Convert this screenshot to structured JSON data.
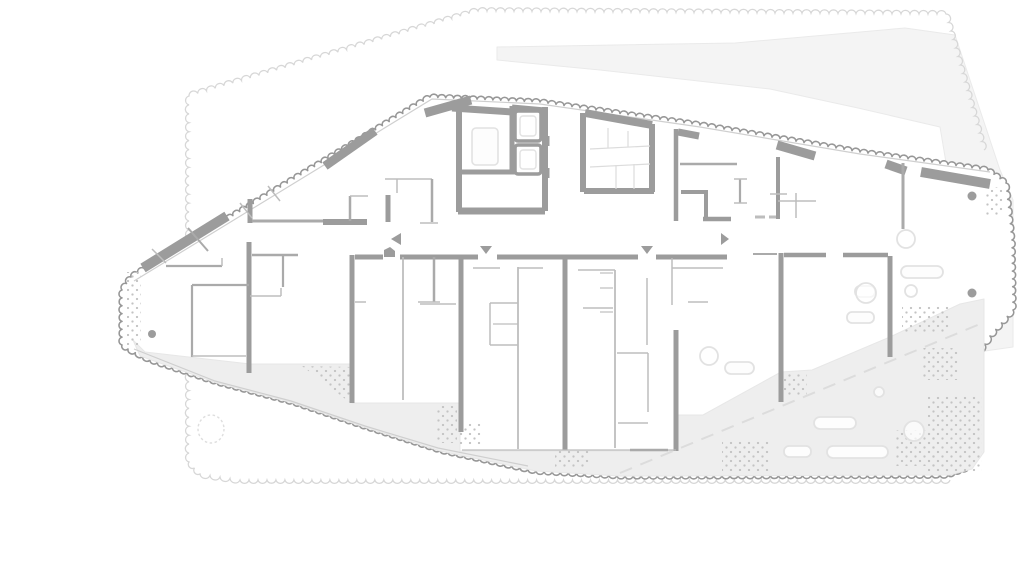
{
  "meta": {
    "label": "architectural floor plan",
    "width": 1024,
    "height": 573
  },
  "colors": {
    "wall": "#9c9c9c",
    "med": "#a6a6a6",
    "part": "#aaaaaa",
    "thin": "#bdbdbd",
    "glaze": "#cfcfcf",
    "boundary": "#979797",
    "ctxLine": "#d7d7d7",
    "ctxFill": "#f4f4f4",
    "ctxStroke": "#eaeaea",
    "terrace": "#eeeeee",
    "terraceStroke": "#e7e7e7",
    "stipple": "#c3c3c3",
    "furn": "#e2e2e2",
    "furnFill": "#fdfdfd",
    "tread": "#dcdcdc",
    "dash": "#dcdcdc",
    "cloud": "#dedede",
    "white": "#ffffff"
  },
  "boundary": {
    "wavelength": 8,
    "strokeWidth": 1.6,
    "pts": [
      [
        122,
        345
      ],
      [
        122,
        290
      ],
      [
        131,
        277
      ],
      [
        430,
        97
      ],
      [
        540,
        102
      ],
      [
        700,
        125
      ],
      [
        860,
        152
      ],
      [
        988,
        170
      ],
      [
        1006,
        183
      ],
      [
        1012,
        240
      ],
      [
        1013,
        310
      ],
      [
        990,
        336
      ],
      [
        979,
        352
      ],
      [
        979,
        450
      ],
      [
        968,
        468
      ],
      [
        948,
        475
      ],
      [
        625,
        476
      ],
      [
        536,
        471
      ],
      [
        440,
        450
      ],
      [
        367,
        427
      ],
      [
        293,
        402
      ],
      [
        217,
        382
      ],
      [
        150,
        360
      ],
      [
        128,
        349
      ]
    ]
  },
  "contextOutline": {
    "wavelength": 9,
    "strokeWidth": 1.3,
    "pts": [
      [
        950,
        480
      ],
      [
        240,
        480
      ],
      [
        200,
        474
      ],
      [
        189,
        462
      ],
      [
        189,
        96
      ],
      [
        478,
        11
      ],
      [
        946,
        14
      ],
      [
        984,
        150
      ]
    ]
  },
  "contextShape": {
    "pts": [
      [
        497,
        47
      ],
      [
        735,
        43
      ],
      [
        905,
        28
      ],
      [
        955,
        35
      ],
      [
        1000,
        170
      ],
      [
        1013,
        200
      ],
      [
        1013,
        347
      ],
      [
        978,
        352
      ],
      [
        940,
        127
      ],
      [
        858,
        108
      ],
      [
        770,
        89
      ],
      [
        600,
        70
      ],
      [
        497,
        60
      ]
    ]
  },
  "terrace": {
    "pts": [
      [
        133,
        340
      ],
      [
        145,
        352
      ],
      [
        250,
        364
      ],
      [
        352,
        364
      ],
      [
        352,
        403
      ],
      [
        460,
        403
      ],
      [
        460,
        451
      ],
      [
        674,
        451
      ],
      [
        674,
        415
      ],
      [
        703,
        415
      ],
      [
        781,
        372
      ],
      [
        812,
        370
      ],
      [
        890,
        337
      ],
      [
        960,
        304
      ],
      [
        984,
        299
      ],
      [
        984,
        452
      ],
      [
        972,
        469
      ],
      [
        950,
        475
      ],
      [
        620,
        476
      ],
      [
        536,
        471
      ],
      [
        440,
        451
      ],
      [
        367,
        428
      ],
      [
        293,
        403
      ],
      [
        217,
        383
      ],
      [
        140,
        356
      ]
    ]
  },
  "glazing": [
    [
      [
        134,
        281
      ],
      [
        432,
        99
      ],
      [
        540,
        104
      ],
      [
        700,
        127
      ],
      [
        860,
        154
      ],
      [
        990,
        172
      ]
    ],
    [
      [
        134,
        349
      ],
      [
        215,
        381
      ],
      [
        291,
        401
      ],
      [
        365,
        426
      ],
      [
        438,
        448
      ],
      [
        528,
        466
      ]
    ]
  ],
  "lines": [
    [
      143,
      268,
      227,
      216,
      10
    ],
    [
      325,
      166,
      375,
      131,
      9
    ],
    [
      425,
      113,
      471,
      100,
      9
    ],
    [
      777,
      145,
      815,
      156,
      9
    ],
    [
      886,
      164,
      906,
      171,
      9
    ],
    [
      921,
      172,
      990,
      184,
      10
    ],
    [
      459,
      106,
      459,
      212,
      6
    ],
    [
      452,
      108,
      512,
      112,
      7
    ],
    [
      512,
      106,
      512,
      172,
      5
    ],
    [
      512,
      108,
      545,
      111,
      7
    ],
    [
      545,
      107,
      545,
      211,
      6
    ],
    [
      461,
      172,
      517,
      172,
      5
    ],
    [
      458,
      211,
      545,
      211,
      7
    ],
    [
      546,
      136,
      546,
      146,
      7
    ],
    [
      546,
      168,
      546,
      178,
      7
    ],
    [
      583,
      113,
      583,
      192,
      6
    ],
    [
      585,
      113,
      652,
      125,
      8
    ],
    [
      652,
      124,
      652,
      192,
      6
    ],
    [
      584,
      191,
      654,
      191,
      6
    ],
    [
      676,
      129,
      676,
      221,
      4.5
    ],
    [
      678,
      132,
      699,
      136,
      7
    ],
    [
      681,
      192,
      707,
      192,
      4
    ],
    [
      706,
      190,
      706,
      219,
      4
    ],
    [
      703,
      219,
      731,
      219,
      4.5
    ],
    [
      680,
      164,
      737,
      164,
      2.5
    ],
    [
      740,
      179,
      740,
      203,
      2.2
    ],
    [
      734,
      179,
      747,
      179,
      1.5
    ],
    [
      734,
      203,
      747,
      203,
      1.5
    ],
    [
      755,
      217,
      765,
      217,
      3,
      "thin"
    ],
    [
      769,
      217,
      779,
      217,
      3,
      "thin"
    ],
    [
      778,
      157,
      778,
      219,
      4
    ],
    [
      778,
      201,
      816,
      201,
      1.5
    ],
    [
      796,
      193,
      796,
      218,
      1.5
    ],
    [
      770,
      194,
      787,
      194,
      1.5
    ],
    [
      903,
      163,
      903,
      229,
      3
    ],
    [
      250,
      199,
      250,
      223,
      5
    ],
    [
      252,
      221,
      324,
      221,
      3
    ],
    [
      323,
      222,
      367,
      222,
      6
    ],
    [
      388,
      195,
      388,
      222,
      5
    ],
    [
      350,
      196,
      350,
      221,
      2.5
    ],
    [
      350,
      196,
      368,
      196,
      1.5
    ],
    [
      385,
      179,
      432,
      179,
      1.5
    ],
    [
      397,
      179,
      397,
      193,
      1.5
    ],
    [
      432,
      179,
      432,
      222,
      2.5
    ],
    [
      420,
      223,
      438,
      223,
      1.5
    ],
    [
      252,
      255,
      298,
      255,
      2.5
    ],
    [
      355,
      257,
      383,
      257,
      5
    ],
    [
      400,
      257,
      478,
      257,
      5
    ],
    [
      497,
      257,
      638,
      257,
      5
    ],
    [
      656,
      257,
      727,
      257,
      5
    ],
    [
      753,
      254,
      777,
      254,
      2
    ],
    [
      784,
      255,
      826,
      255,
      4.5
    ],
    [
      843,
      255,
      888,
      255,
      4.5
    ],
    [
      249,
      242,
      249,
      373,
      5
    ],
    [
      352,
      255,
      352,
      403,
      5
    ],
    [
      461,
      257,
      461,
      432,
      5
    ],
    [
      565,
      257,
      565,
      450,
      5
    ],
    [
      676,
      330,
      676,
      451,
      5
    ],
    [
      781,
      253,
      781,
      402,
      5
    ],
    [
      890,
      256,
      890,
      357,
      5
    ],
    [
      403,
      257,
      403,
      400,
      1.8
    ],
    [
      434,
      257,
      434,
      302,
      2.5
    ],
    [
      518,
      267,
      518,
      449,
      1.8
    ],
    [
      615,
      270,
      615,
      448,
      1.8
    ],
    [
      283,
      254,
      283,
      287,
      2.2
    ],
    [
      250,
      296,
      281,
      296,
      1.5
    ],
    [
      281,
      288,
      281,
      296,
      1.5
    ],
    [
      192,
      285,
      192,
      357,
      2.2
    ],
    [
      192,
      285,
      249,
      285,
      2.2
    ],
    [
      192,
      356,
      246,
      356,
      1.5
    ],
    [
      166,
      266,
      222,
      266,
      2.2
    ],
    [
      222,
      258,
      222,
      266,
      1.5
    ],
    [
      188,
      228,
      208,
      251,
      2
    ],
    [
      152,
      249,
      166,
      263,
      1.5
    ],
    [
      240,
      203,
      252,
      218,
      1.5
    ],
    [
      268,
      186,
      280,
      201,
      1.5
    ],
    [
      418,
      302,
      440,
      302,
      1.5
    ],
    [
      355,
      302,
      366,
      302,
      1.5
    ],
    [
      473,
      268,
      500,
      268,
      1.5
    ],
    [
      518,
      268,
      543,
      268,
      1.5
    ],
    [
      578,
      270,
      615,
      270,
      1.5
    ],
    [
      583,
      308,
      613,
      308,
      1.5
    ],
    [
      420,
      304,
      456,
      304,
      1.5
    ],
    [
      490,
      303,
      490,
      345,
      1.5
    ],
    [
      490,
      303,
      518,
      303,
      1.5
    ],
    [
      490,
      345,
      518,
      345,
      1.5
    ],
    [
      493,
      324,
      518,
      324,
      1.2
    ],
    [
      617,
      353,
      648,
      353,
      1.5
    ],
    [
      648,
      353,
      648,
      412,
      1.5
    ],
    [
      618,
      423,
      648,
      423,
      1.5
    ],
    [
      462,
      450,
      676,
      450,
      1.2,
      "thin"
    ],
    [
      630,
      450,
      668,
      450,
      2.5
    ],
    [
      672,
      258,
      672,
      305,
      1.5
    ],
    [
      672,
      268,
      723,
      268,
      1.5
    ],
    [
      688,
      302,
      708,
      302,
      1.5
    ],
    [
      647,
      278,
      647,
      345,
      1.5
    ],
    [
      600,
      273,
      613,
      273,
      1.2
    ],
    [
      600,
      288,
      613,
      288,
      1.2
    ],
    [
      600,
      312,
      613,
      312,
      1.2
    ]
  ],
  "treads": [
    [
      590,
      149,
      650,
      146
    ],
    [
      590,
      167,
      650,
      164
    ],
    [
      608,
      128,
      608,
      148
    ],
    [
      628,
      131,
      628,
      147
    ],
    [
      616,
      165,
      616,
      189
    ],
    [
      634,
      164,
      634,
      189
    ]
  ],
  "furniture": {
    "lobbyCar": [
      472,
      128,
      26,
      37,
      4
    ],
    "shafts": [
      {
        "box": [
          515,
          111,
          26,
          30
        ],
        "inner": [
          520,
          116,
          16,
          20
        ]
      },
      {
        "box": [
          515,
          145,
          26,
          29
        ],
        "inner": [
          520,
          150,
          16,
          19
        ]
      }
    ],
    "benches": [
      [
        901,
        266,
        42,
        12,
        6
      ],
      [
        855,
        286,
        20,
        11,
        5
      ],
      [
        847,
        312,
        27,
        11,
        5
      ],
      [
        725,
        362,
        29,
        12,
        6
      ],
      [
        814,
        417,
        42,
        12,
        6
      ],
      [
        784,
        446,
        27,
        11,
        5
      ],
      [
        827,
        446,
        61,
        12,
        6
      ]
    ],
    "circles": [
      [
        906,
        239,
        9
      ],
      [
        866,
        293,
        10
      ],
      [
        911,
        291,
        6
      ],
      [
        709,
        356,
        9
      ],
      [
        879,
        392,
        5
      ],
      [
        914,
        431,
        10
      ]
    ]
  },
  "columns": [
    [
      152,
      334,
      4
    ],
    [
      972,
      196,
      4.5
    ],
    [
      972,
      293,
      4.5
    ]
  ],
  "doorMarkers": {
    "triangles": [
      [
        [
          391,
          239
        ],
        [
          401,
          233
        ],
        [
          401,
          245
        ]
      ],
      [
        [
          480,
          246
        ],
        [
          492,
          246
        ],
        [
          486,
          254
        ]
      ],
      [
        [
          641,
          246
        ],
        [
          653,
          246
        ],
        [
          647,
          254
        ]
      ],
      [
        [
          721,
          233
        ],
        [
          721,
          245
        ],
        [
          729,
          239
        ]
      ]
    ],
    "pentagon": [
      [
        384,
        257
      ],
      [
        384,
        250
      ],
      [
        390,
        247
      ],
      [
        395,
        251
      ],
      [
        395,
        257
      ]
    ]
  },
  "stipples": [
    [
      [
        127,
        272
      ],
      [
        141,
        272
      ],
      [
        141,
        345
      ],
      [
        127,
        345
      ]
    ],
    [
      [
        302,
        366
      ],
      [
        352,
        367
      ],
      [
        352,
        404
      ]
    ],
    [
      [
        437,
        406
      ],
      [
        457,
        406
      ],
      [
        457,
        443
      ],
      [
        437,
        443
      ]
    ],
    [
      [
        460,
        422
      ],
      [
        482,
        422
      ],
      [
        482,
        445
      ],
      [
        460,
        445
      ]
    ],
    [
      [
        555,
        450
      ],
      [
        590,
        450
      ],
      [
        590,
        468
      ],
      [
        555,
        468
      ]
    ],
    [
      [
        722,
        441
      ],
      [
        770,
        441
      ],
      [
        770,
        471
      ],
      [
        722,
        471
      ]
    ],
    [
      [
        783,
        374
      ],
      [
        807,
        374
      ],
      [
        807,
        395
      ],
      [
        783,
        395
      ]
    ],
    [
      [
        902,
        306
      ],
      [
        949,
        306
      ],
      [
        949,
        334
      ],
      [
        902,
        334
      ]
    ],
    [
      [
        922,
        348
      ],
      [
        958,
        348
      ],
      [
        958,
        380
      ],
      [
        922,
        380
      ]
    ],
    [
      [
        928,
        396
      ],
      [
        982,
        396
      ],
      [
        982,
        472
      ],
      [
        928,
        472
      ]
    ],
    [
      [
        896,
        430
      ],
      [
        938,
        430
      ],
      [
        938,
        466
      ],
      [
        896,
        466
      ]
    ],
    [
      [
        986,
        187
      ],
      [
        1004,
        187
      ],
      [
        1004,
        215
      ],
      [
        986,
        215
      ]
    ]
  ],
  "dashedLine": {
    "x1": 620,
    "y1": 473,
    "x2": 980,
    "y2": 324,
    "dash": "13 9",
    "width": 2
  },
  "cloud": {
    "cx": 211,
    "cy": 429,
    "rx": 13,
    "ry": 14,
    "dash": "2.5 2.5"
  }
}
